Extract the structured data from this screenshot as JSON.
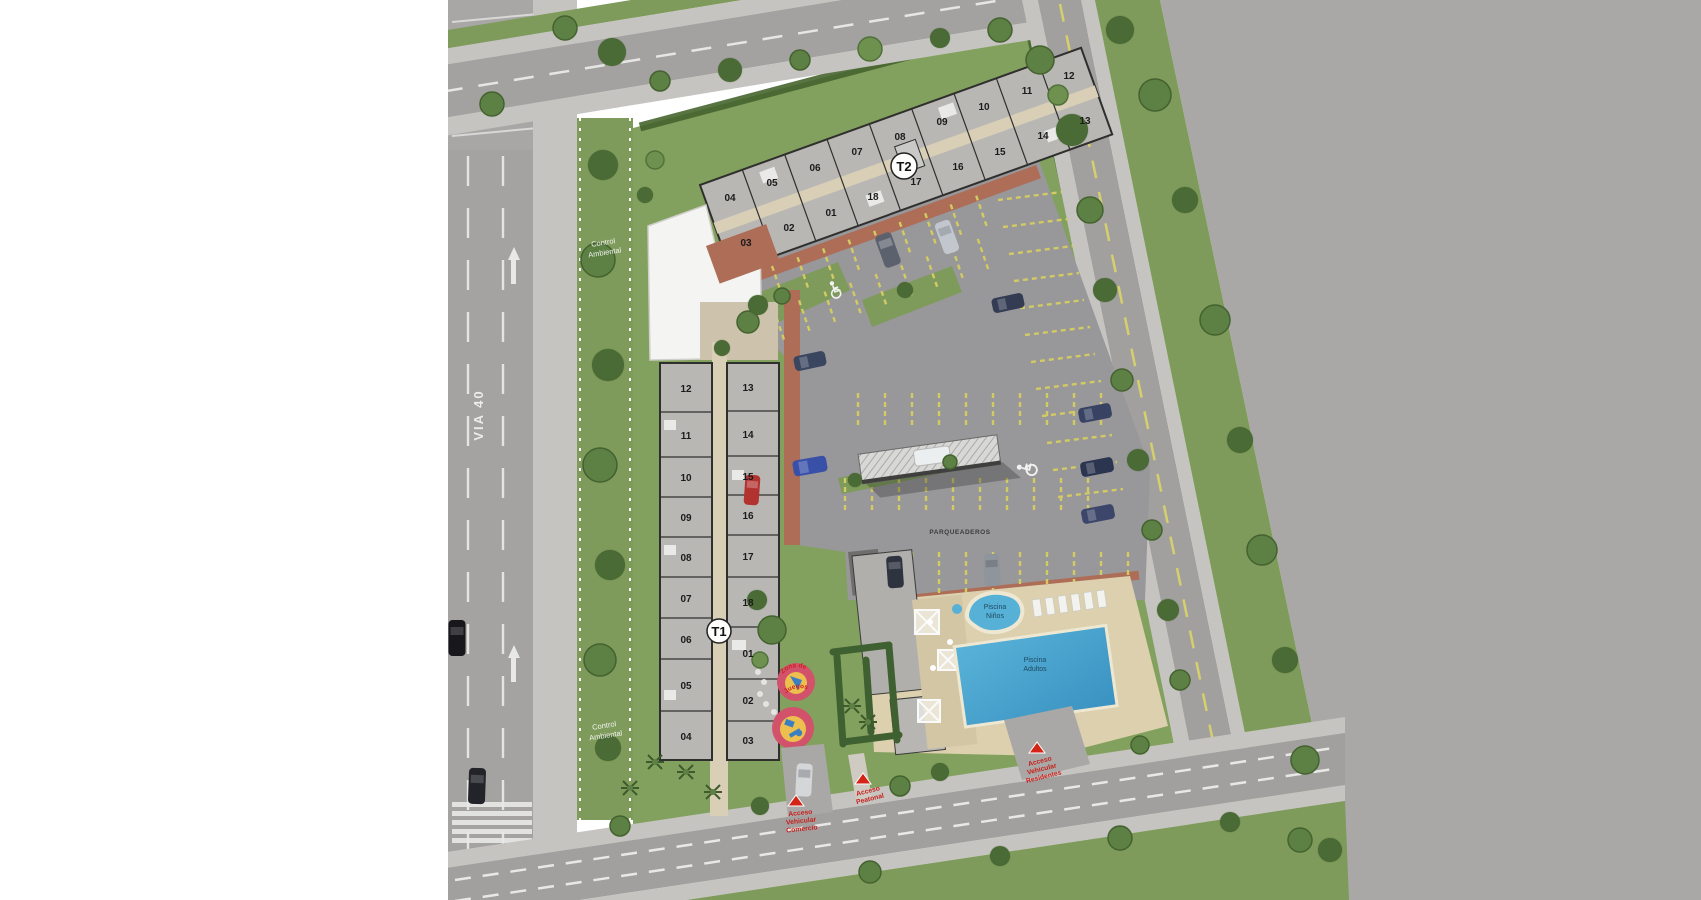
{
  "roads": {
    "via40": "VIA 40"
  },
  "environment": {
    "control_ambiental_top_lines": [
      "Control",
      "Ambiental"
    ],
    "control_ambiental_bottom_lines": [
      "Control",
      "Ambiental"
    ]
  },
  "parking": {
    "label": "PARQUEADEROS"
  },
  "pools": {
    "kids_lines": [
      "Piscina",
      "Niños"
    ],
    "adults_lines": [
      "Piscina",
      "Adultos"
    ]
  },
  "playground": {
    "label_lines": [
      "Zona de",
      "Juegos"
    ]
  },
  "access": {
    "vehicular_comercio_lines": [
      "Acceso",
      "Vehicular",
      "Comercio"
    ],
    "peatonal_lines": [
      "Acceso",
      "Peatonal"
    ],
    "vehicular_residentes_lines": [
      "Acceso",
      "Vehicular",
      "Residentes"
    ]
  },
  "towers": {
    "t1": {
      "badge": "T1",
      "left_column": [
        "12",
        "11",
        "10",
        "09",
        "08",
        "07",
        "06",
        "05",
        "04"
      ],
      "right_column": [
        "13",
        "14",
        "15",
        "16",
        "17",
        "18",
        "01",
        "02",
        "03"
      ]
    },
    "t2": {
      "badge": "T2",
      "top_row": [
        "04",
        "05",
        "06",
        "07",
        "08",
        "09",
        "10",
        "11",
        "12"
      ],
      "bottom_row": [
        "03",
        "02",
        "01",
        "18",
        "17",
        "16",
        "15",
        "14",
        "13"
      ]
    }
  },
  "colors": {
    "pool_water": "#46a0cc",
    "pool_kids": "#57b1d6",
    "playground_ring": "#d1526a",
    "playground_center": "#ecbf4e",
    "access_marker_red": "#d42417",
    "parking_line_yellow": "#d2ca62",
    "lawn_green": "#83a15e",
    "asphalt_gray": "#a1a09e"
  }
}
